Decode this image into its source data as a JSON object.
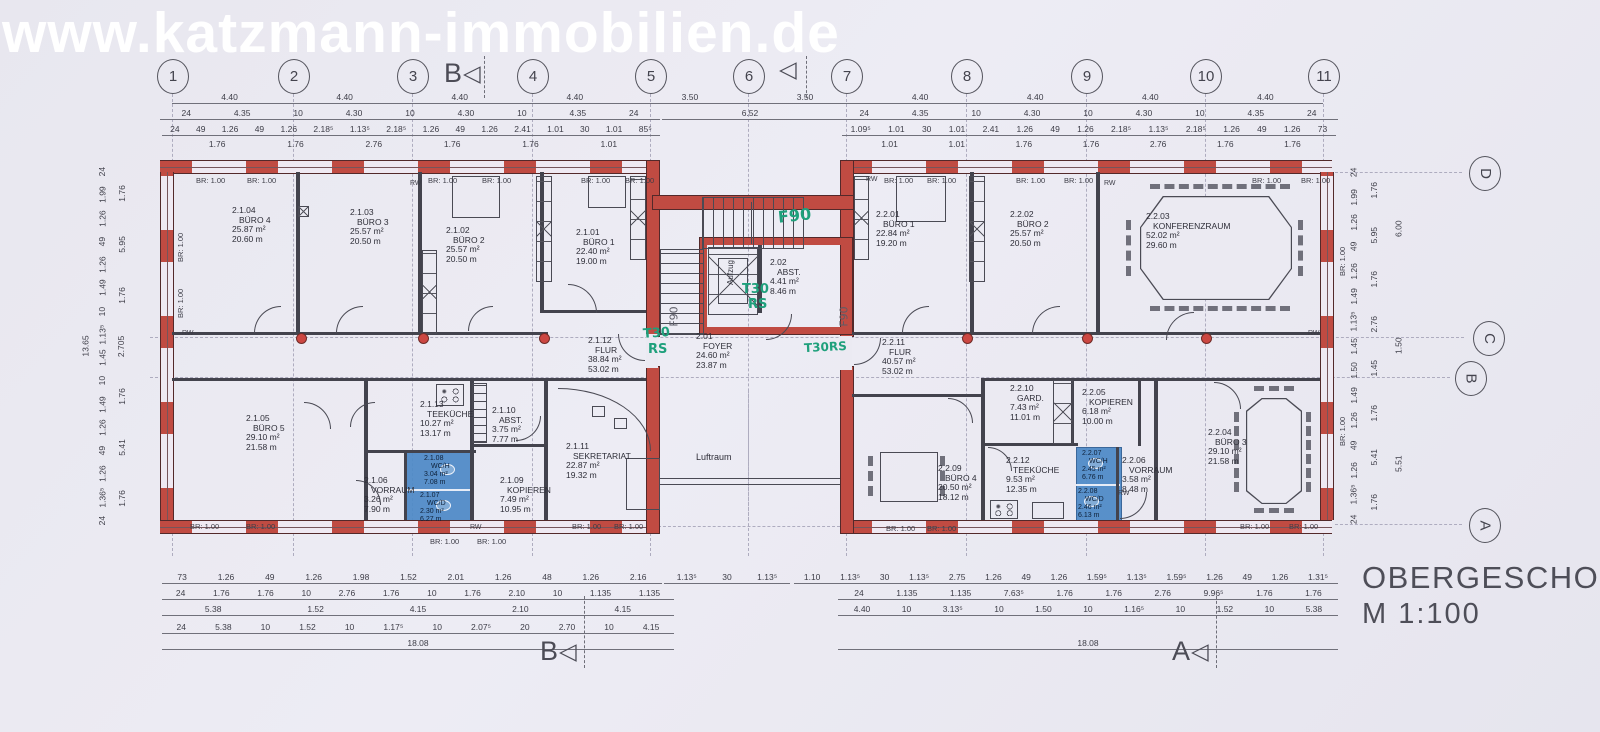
{
  "meta": {
    "watermark": "www.katzmann-immobilien.de",
    "title": "OBERGESCHOSS",
    "scale": "M  1:100",
    "colors": {
      "wall_red": "#c04b42",
      "wc_blue": "#4e8ac7",
      "annotation_green": "#1fa07c",
      "paper": "#eae9f1",
      "line": "#43434d",
      "watermark_white": "#ffffff"
    }
  },
  "labels": {
    "watermark": "www.katzmann-immobilien.de",
    "title": "OBERGESCHOSS",
    "scale": "M  1:100",
    "br": "BR: 1.00",
    "rw": "RW",
    "aufzug": "Aufzug",
    "luftraum": "Luftraum",
    "arrow": "◁"
  },
  "grid": {
    "columns": [
      {
        "l": "1",
        "x": 172
      },
      {
        "l": "2",
        "x": 293
      },
      {
        "l": "3",
        "x": 412
      },
      {
        "l": "4",
        "x": 532
      },
      {
        "l": "5",
        "x": 650
      },
      {
        "l": "6",
        "x": 748
      },
      {
        "l": "7",
        "x": 846
      },
      {
        "l": "8",
        "x": 966
      },
      {
        "l": "9",
        "x": 1086
      },
      {
        "l": "10",
        "x": 1205
      },
      {
        "l": "11",
        "x": 1323
      }
    ],
    "rows": [
      {
        "l": "D",
        "x": 1484,
        "y": 172,
        "x1": 1335,
        "x2": 1462
      },
      {
        "l": "C",
        "x": 1488,
        "y": 337,
        "x1": 150,
        "x2": 1464
      },
      {
        "l": "B",
        "x": 1470,
        "y": 377,
        "x1": 150,
        "x2": 1450
      },
      {
        "l": "A",
        "x": 1484,
        "y": 524,
        "x1": 1335,
        "x2": 1462
      }
    ]
  },
  "section_markers": [
    {
      "l": "B",
      "x": 444,
      "y": 58,
      "lx": 484,
      "ly": 56,
      "lh": 42
    },
    {
      "l": "",
      "x": 778,
      "y": 58,
      "lx": 806,
      "ly": 56,
      "lh": 42
    },
    {
      "l": "B",
      "x": 540,
      "y": 636,
      "lx": 584,
      "ly": 596,
      "lh": 72
    },
    {
      "l": "A",
      "x": 1172,
      "y": 636,
      "lx": 1216,
      "ly": 596,
      "lh": 72
    }
  ],
  "rooms": [
    {
      "id": "2.1.04",
      "name": "BÜRO 4",
      "area": "25.87 m²",
      "per": "20.60 m",
      "x": 232,
      "y": 206
    },
    {
      "id": "2.1.03",
      "name": "BÜRO 3",
      "area": "25.57 m²",
      "per": "20.50 m",
      "x": 350,
      "y": 208
    },
    {
      "id": "2.1.02",
      "name": "BÜRO 2",
      "area": "25.57 m²",
      "per": "20.50 m",
      "x": 446,
      "y": 226
    },
    {
      "id": "2.1.01",
      "name": "BÜRO 1",
      "area": "22.40 m²",
      "per": "19.00 m",
      "x": 576,
      "y": 228
    },
    {
      "id": "2.1.12",
      "name": "FLUR",
      "area": "38.84 m²",
      "per": "53.02 m",
      "x": 588,
      "y": 336
    },
    {
      "id": "2.1.05",
      "name": "BÜRO 5",
      "area": "29.10 m²",
      "per": "21.58 m",
      "x": 246,
      "y": 414
    },
    {
      "id": "2.1.13",
      "name": "TEEKÜCHE",
      "area": "10.27 m²",
      "per": "13.17 m",
      "x": 420,
      "y": 400
    },
    {
      "id": "2.1.10",
      "name": "ABST.",
      "area": "3.75 m²",
      "per": "7.77 m",
      "x": 492,
      "y": 406
    },
    {
      "id": "2.1.09",
      "name": "KOPIEREN",
      "area": "7.49 m²",
      "per": "10.95 m",
      "x": 500,
      "y": 476
    },
    {
      "id": "2.1.06",
      "name": "VORRAUM",
      "area": "3.26 m²",
      "per": "7.90 m",
      "x": 364,
      "y": 476
    },
    {
      "id": "2.1.08",
      "name": "WC/H",
      "area": "3.04 m²",
      "per": "7.08 m",
      "x": 424,
      "y": 455,
      "sm": 1
    },
    {
      "id": "2.1.07",
      "name": "WC/D",
      "area": "2.30 m²",
      "per": "6.27 m",
      "x": 420,
      "y": 492,
      "sm": 1
    },
    {
      "id": "2.1.11",
      "name": "SEKRETARIAT",
      "area": "22.87 m²",
      "per": "19.32 m",
      "x": 566,
      "y": 442
    },
    {
      "id": "2.02",
      "name": "ABST.",
      "area": "4.41 m²",
      "per": "8.46 m",
      "x": 770,
      "y": 258
    },
    {
      "id": "2.01",
      "name": "FOYER",
      "area": "24.60 m²",
      "per": "23.87 m",
      "x": 696,
      "y": 332
    },
    {
      "id": "2.2.01",
      "name": "BÜRO 1",
      "area": "22.84 m²",
      "per": "19.20 m",
      "x": 876,
      "y": 210
    },
    {
      "id": "2.2.02",
      "name": "BÜRO 2",
      "area": "25.57 m²",
      "per": "20.50 m",
      "x": 1010,
      "y": 210
    },
    {
      "id": "2.2.03",
      "name": "KONFERENZRAUM",
      "area": "52.02 m²",
      "per": "29.60 m",
      "x": 1146,
      "y": 212
    },
    {
      "id": "2.2.11",
      "name": "FLUR",
      "area": "40.57 m²",
      "per": "53.02 m",
      "x": 882,
      "y": 338
    },
    {
      "id": "2.2.10",
      "name": "GARD.",
      "area": "7.43 m²",
      "per": "11.01 m",
      "x": 1010,
      "y": 384
    },
    {
      "id": "2.2.05",
      "name": "KOPIEREN",
      "area": "6.18 m²",
      "per": "10.00 m",
      "x": 1082,
      "y": 388
    },
    {
      "id": "2.2.09",
      "name": "BÜRO 4",
      "area": "20.50 m²",
      "per": "18.12 m",
      "x": 938,
      "y": 464
    },
    {
      "id": "2.2.12",
      "name": "TEEKÜCHE",
      "area": "9.53 m²",
      "per": "12.35 m",
      "x": 1006,
      "y": 456
    },
    {
      "id": "2.2.07",
      "name": "WC/H",
      "area": "2.45 m²",
      "per": "6.76 m",
      "x": 1082,
      "y": 450,
      "sm": 1
    },
    {
      "id": "2.2.08",
      "name": "WC/D",
      "area": "2.46 m²",
      "per": "6.13 m",
      "x": 1078,
      "y": 488,
      "sm": 1
    },
    {
      "id": "2.2.06",
      "name": "VORRAUM",
      "area": "3.58 m²",
      "per": "8.48 m",
      "x": 1122,
      "y": 456
    },
    {
      "id": "2.2.04",
      "name": "BÜRO 3",
      "area": "29.10 m²",
      "per": "21.58 m",
      "x": 1208,
      "y": 428
    }
  ],
  "dim_chains": [
    {
      "x": 172,
      "y": 92,
      "w": 1151,
      "v": [
        "4.40",
        "4.40",
        "4.40",
        "4.40",
        "3.50",
        "3.50",
        "4.40",
        "4.40",
        "4.40",
        "4.40"
      ],
      "line": 1
    },
    {
      "x": 160,
      "y": 108,
      "w": 500,
      "v": [
        "24",
        "4.35",
        "10",
        "4.30",
        "10",
        "4.30",
        "10",
        "4.35",
        "24"
      ],
      "line": 1
    },
    {
      "x": 662,
      "y": 108,
      "w": 176,
      "v": [
        "6.52"
      ],
      "line": 1
    },
    {
      "x": 838,
      "y": 108,
      "w": 500,
      "v": [
        "24",
        "4.35",
        "10",
        "4.30",
        "10",
        "4.30",
        "10",
        "4.35",
        "24"
      ],
      "line": 1
    },
    {
      "x": 162,
      "y": 124,
      "w": 498,
      "v": [
        "24",
        "49",
        "1.26",
        "49",
        "1.26",
        "2.18⁵",
        "1.13⁵",
        "2.18⁵",
        "1.26",
        "49",
        "1.26",
        "2.41",
        "1.01",
        "30",
        "1.01",
        "85⁵"
      ],
      "line": 1
    },
    {
      "x": 842,
      "y": 124,
      "w": 494,
      "v": [
        "1.09⁵",
        "1.01",
        "30",
        "1.01",
        "2.41",
        "1.26",
        "49",
        "1.26",
        "2.18⁵",
        "1.13⁵",
        "2.18⁵",
        "1.26",
        "49",
        "1.26",
        "73"
      ],
      "line": 1
    },
    {
      "x": 178,
      "y": 139,
      "w": 470,
      "v": [
        "1.76",
        "1.76",
        "2.76",
        "1.76",
        "1.76",
        "1.01"
      ]
    },
    {
      "x": 856,
      "y": 139,
      "w": 470,
      "v": [
        "1.01",
        "1.01",
        "1.76",
        "1.76",
        "2.76",
        "1.76",
        "1.76"
      ]
    },
    {
      "x": 162,
      "y": 572,
      "w": 500,
      "v": [
        "73",
        "1.26",
        "49",
        "1.26",
        "1.98",
        "1.52",
        "2.01",
        "1.26",
        "48",
        "1.26",
        "2.16"
      ],
      "line": 1
    },
    {
      "x": 664,
      "y": 572,
      "w": 126,
      "v": [
        "1.13⁵",
        "30",
        "1.13⁵"
      ],
      "line": 1
    },
    {
      "x": 794,
      "y": 572,
      "w": 544,
      "v": [
        "1.10",
        "1.13⁵",
        "30",
        "1.13⁵",
        "2.75",
        "1.26",
        "49",
        "1.26",
        "1.59⁵",
        "1.13⁵",
        "1.59⁵",
        "1.26",
        "49",
        "1.26",
        "1.31⁵"
      ],
      "line": 1
    },
    {
      "x": 162,
      "y": 588,
      "w": 512,
      "v": [
        "24",
        "1.76",
        "1.76",
        "10",
        "2.76",
        "1.76",
        "10",
        "1.76",
        "2.10",
        "10",
        "1.135",
        "1.135"
      ],
      "line": 1
    },
    {
      "x": 838,
      "y": 588,
      "w": 500,
      "v": [
        "24",
        "1.135",
        "1.135",
        "7.63⁵",
        "1.76",
        "1.76",
        "2.76",
        "9.96⁵",
        "1.76",
        "1.76"
      ],
      "line": 1
    },
    {
      "x": 162,
      "y": 604,
      "w": 512,
      "v": [
        "5.38",
        "1.52",
        "4.15",
        "2.10",
        "4.15"
      ],
      "line": 1
    },
    {
      "x": 838,
      "y": 604,
      "w": 500,
      "v": [
        "4.40",
        "10",
        "3.13⁵",
        "10",
        "1.50",
        "10",
        "1.16⁵",
        "10",
        "1.52",
        "10",
        "5.38"
      ],
      "line": 1
    },
    {
      "x": 162,
      "y": 622,
      "w": 512,
      "v": [
        "24",
        "5.38",
        "10",
        "1.52",
        "10",
        "1.17⁵",
        "10",
        "2.07⁵",
        "20",
        "2.70",
        "10",
        "4.15"
      ],
      "line": 1
    },
    {
      "x": 162,
      "y": 638,
      "w": 512,
      "v": [
        "18.08"
      ],
      "line": 1
    },
    {
      "x": 838,
      "y": 638,
      "w": 500,
      "v": [
        "18.08"
      ],
      "line": 1
    },
    {
      "x": 96,
      "y": 160,
      "h": 372,
      "vert": 1,
      "v": [
        "24",
        "1.99",
        "1.26",
        "49",
        "1.26",
        "1.49",
        "10",
        "1.13⁵",
        "1.45",
        "10",
        "1.49",
        "1.26",
        "49",
        "1.26",
        "1.36⁵",
        "24"
      ]
    },
    {
      "x": 116,
      "y": 168,
      "h": 356,
      "vert": 1,
      "v": [
        "1.76",
        "5.95",
        "1.76",
        "2.705",
        "1.76",
        "5.41",
        "1.76"
      ]
    },
    {
      "x": 80,
      "y": 170,
      "h": 352,
      "vert": 1,
      "v": [
        "13.65"
      ]
    },
    {
      "x": 1348,
      "y": 160,
      "h": 372,
      "vert": 1,
      "v": [
        "24",
        "1.99",
        "1.26",
        "49",
        "1.26",
        "1.49",
        "1.13⁵",
        "1.45",
        "1.50",
        "1.49",
        "1.26",
        "49",
        "1.26",
        "1.36⁵",
        "24"
      ]
    },
    {
      "x": 1368,
      "y": 168,
      "h": 356,
      "vert": 1,
      "v": [
        "1.76",
        "5.95",
        "1.76",
        "2.76",
        "1.45",
        "1.76",
        "5.41",
        "1.76"
      ]
    },
    {
      "x": 1392,
      "y": 170,
      "h": 352,
      "vert": 1,
      "v": [
        "6.00",
        "1.50",
        "5.51"
      ]
    }
  ],
  "br_labels": [
    [
      196,
      176,
      "h"
    ],
    [
      247,
      176,
      "h"
    ],
    [
      428,
      176,
      "h"
    ],
    [
      482,
      176,
      "h"
    ],
    [
      581,
      176,
      "h"
    ],
    [
      625,
      176,
      "h"
    ],
    [
      884,
      176,
      "h"
    ],
    [
      927,
      176,
      "h"
    ],
    [
      1016,
      176,
      "h"
    ],
    [
      1064,
      176,
      "h"
    ],
    [
      1252,
      176,
      "h"
    ],
    [
      1301,
      176,
      "h"
    ],
    [
      190,
      522,
      "h"
    ],
    [
      246,
      522,
      "h"
    ],
    [
      430,
      537,
      "h"
    ],
    [
      477,
      537,
      "h"
    ],
    [
      572,
      522,
      "h"
    ],
    [
      614,
      522,
      "h"
    ],
    [
      886,
      524,
      "h"
    ],
    [
      927,
      524,
      "h"
    ],
    [
      1240,
      522,
      "h"
    ],
    [
      1289,
      522,
      "h"
    ],
    [
      176,
      262,
      "v"
    ],
    [
      176,
      318,
      "v"
    ],
    [
      1338,
      276,
      "v"
    ],
    [
      1338,
      446,
      "v"
    ]
  ],
  "rw_labels": [
    [
      410,
      180
    ],
    [
      866,
      176
    ],
    [
      1104,
      180
    ],
    [
      470,
      524
    ],
    [
      1118,
      490
    ],
    [
      182,
      330
    ],
    [
      1308,
      330
    ]
  ],
  "dots": [
    [
      300,
      335
    ],
    [
      422,
      335
    ],
    [
      543,
      335
    ],
    [
      966,
      335
    ],
    [
      1086,
      335
    ],
    [
      1205,
      335
    ]
  ],
  "annotations": [
    {
      "t": "F90",
      "x": 778,
      "y": 206,
      "c": "g",
      "r": -6,
      "s": 16
    },
    {
      "t": "T30",
      "x": 742,
      "y": 282,
      "c": "g",
      "r": 0,
      "s": 13
    },
    {
      "t": "RS",
      "x": 748,
      "y": 297,
      "c": "g",
      "r": 0,
      "s": 13
    },
    {
      "t": "T30",
      "x": 643,
      "y": 326,
      "c": "g",
      "r": -4,
      "s": 13
    },
    {
      "t": "RS",
      "x": 648,
      "y": 342,
      "c": "g",
      "r": 0,
      "s": 13
    },
    {
      "t": "T30RS",
      "x": 804,
      "y": 340,
      "c": "g",
      "r": -3,
      "s": 12
    },
    {
      "t": "F90",
      "x": 664,
      "y": 310,
      "c": "p",
      "r": -90,
      "s": 11
    },
    {
      "t": "F90",
      "x": 834,
      "y": 310,
      "c": "p",
      "r": -90,
      "s": 11
    }
  ]
}
